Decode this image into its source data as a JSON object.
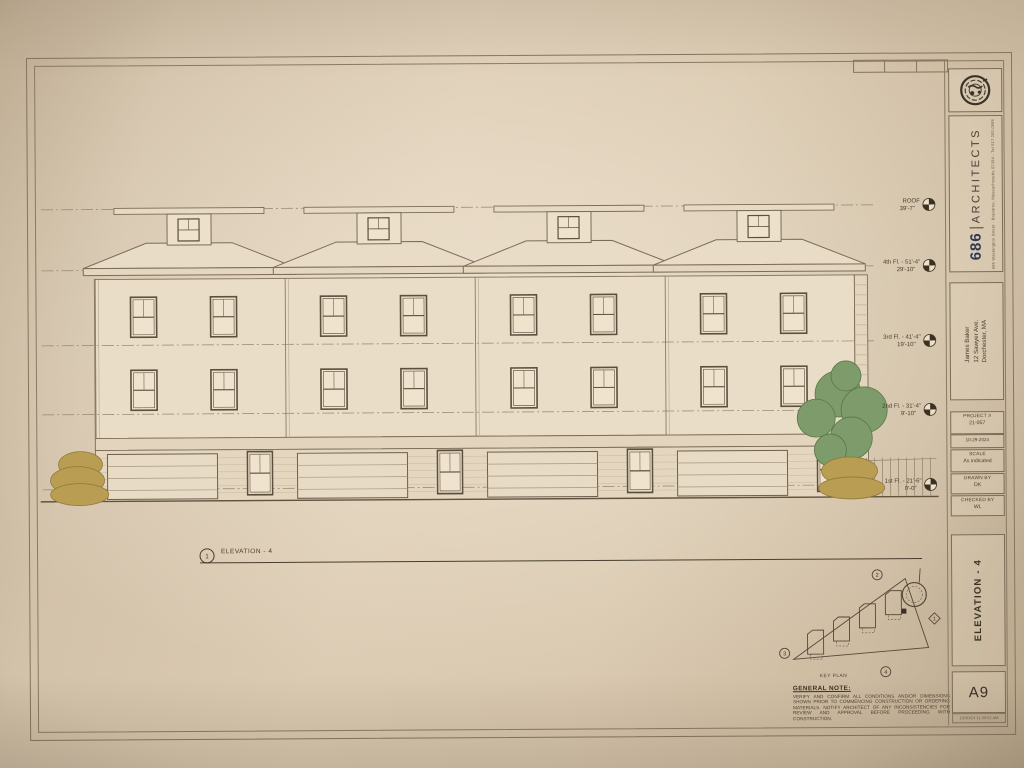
{
  "title_block": {
    "firm": {
      "number": "686",
      "name": "ARCHITECTS",
      "address": "686 Washington Street - Braintree, Massachusetts 02184 - Tel 617.282.0686"
    },
    "client": [
      "James Baker",
      "12 Sawyer Ave.",
      "Dorchester, MA"
    ],
    "info": [
      {
        "label": "PROJECT #",
        "value": "21-057"
      },
      {
        "label": "DATE",
        "value": "10-29-2024"
      },
      {
        "label": "SCALE",
        "value": "As indicated"
      },
      {
        "label": "DRAWN BY",
        "value": "DK"
      },
      {
        "label": "CHECKED BY",
        "value": "WL"
      }
    ],
    "sheet_title": "ELEVATION - 4",
    "sheet_number": "A9",
    "plot_stamp": "10/30/24 11:39:52 AM"
  },
  "drawing": {
    "callout": {
      "number": "1",
      "label": "ELEVATION - 4"
    },
    "levels": [
      {
        "text1": "ROOF",
        "text2": "39'-7\""
      },
      {
        "text1": "4th Fl. - 51'-4\"",
        "text2": "29'-10\""
      },
      {
        "text1": "3rd Fl. - 41'-4\"",
        "text2": "19'-10\""
      },
      {
        "text1": "2nd Fl. - 31'-4\"",
        "text2": "9'-10\""
      },
      {
        "text1": "1st Fl. - 21'-6\"",
        "text2": "0'-0\""
      }
    ],
    "key_plan": {
      "label": "KEY PLAN",
      "markers": {
        "top": "2",
        "left": "3",
        "bottom": "4",
        "right": "1"
      }
    },
    "general_note": {
      "heading": "GENERAL NOTE:",
      "body": "VERIFY AND CONFIRM ALL CONDITIONS AND/OR DIMENSIONS SHOWN PRIOR TO COMMENCING CONSTRUCTION OR ORDERING MATERIALS. NOTIFY ARCHITECT OF ANY INCONSISTENCIES FOR REVIEW AND APPROVAL BEFORE PROCEEDING WITH CONSTRUCTION."
    }
  }
}
